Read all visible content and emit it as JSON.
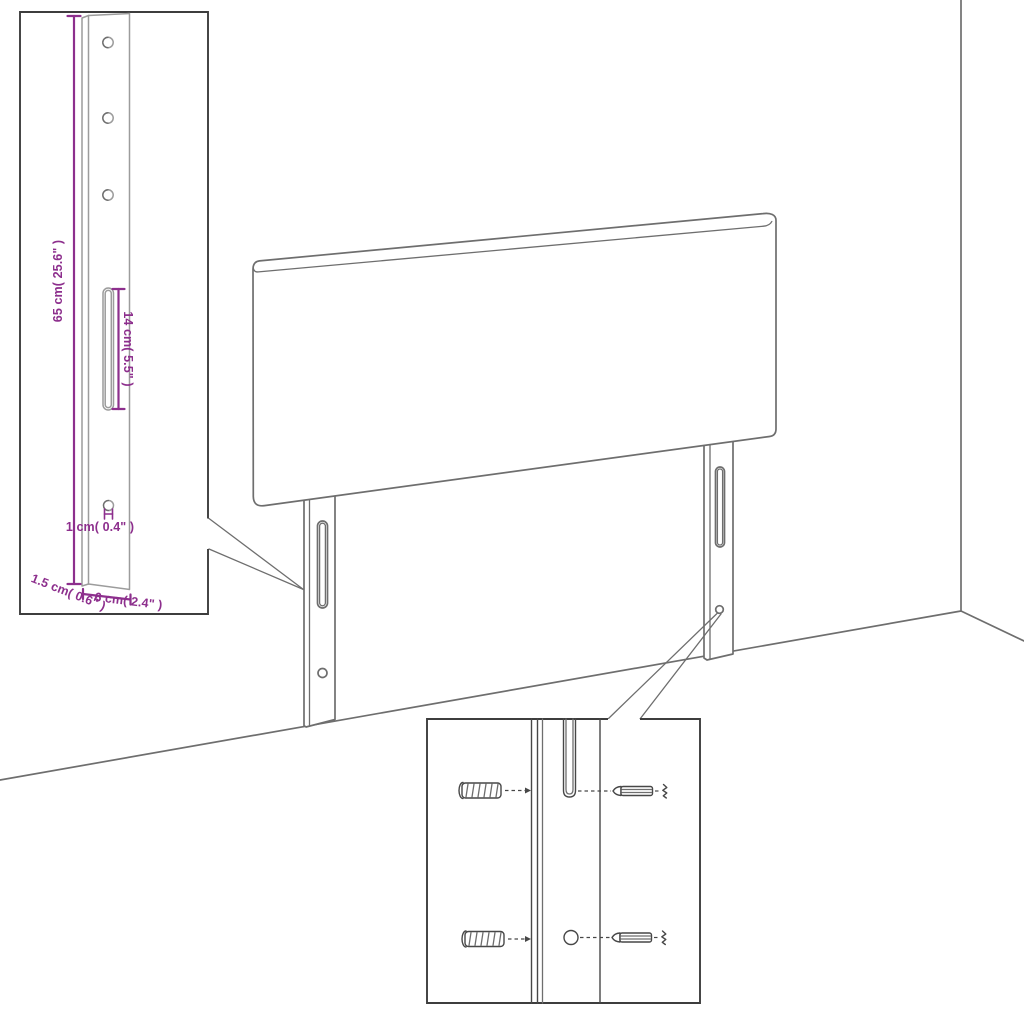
{
  "figure": "headboard-assembly-dimension-diagram",
  "colors": {
    "dimension": "#8d2f8d",
    "outline": "#6e6e6e",
    "inset_outline": "#9c9c9c",
    "box_border": "#3d3d3d",
    "hardware": "#474747",
    "background": "#ffffff"
  },
  "dimensions": {
    "height": "65 cm( 25.6\" )",
    "slot": "14 cm( 5.5\" )",
    "hole": "1 cm( 0.4\" )",
    "width": "6 cm( 2.4\" )",
    "depth": "1.5 cm( 0.6\" )"
  }
}
